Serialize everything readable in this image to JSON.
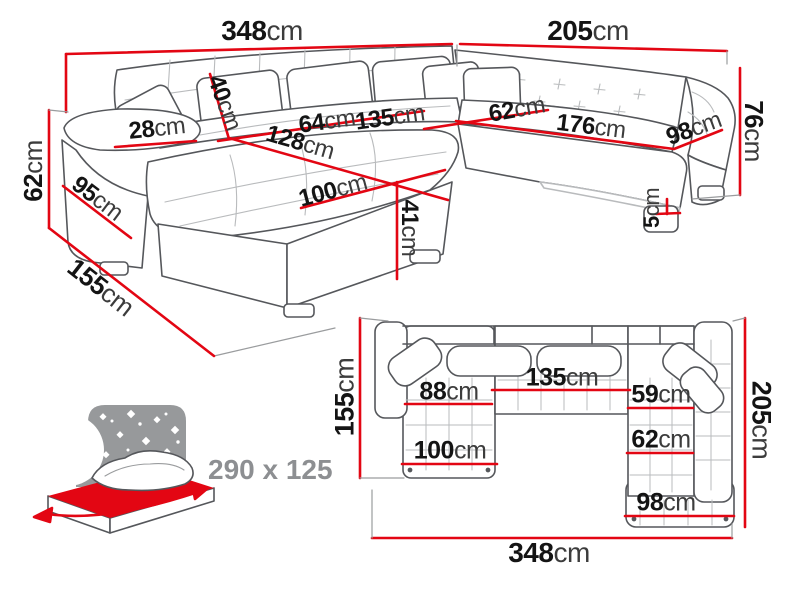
{
  "diagram_title": "corner-sofa-dimensions",
  "colors": {
    "dimension_red": "#e30613",
    "outline_gray": "#55575b",
    "quilt_gray": "#b9bbbd",
    "text_black": "#141414",
    "text_gray": "#8d8f92",
    "icon_gray": "#97999b",
    "mattress_red": "#e30613"
  },
  "perspective": {
    "dims": {
      "total_width": {
        "value": "348",
        "unit": "cm"
      },
      "right_width": {
        "value": "205",
        "unit": "cm"
      },
      "back_height": {
        "value": "76",
        "unit": "cm"
      },
      "arm_height": {
        "value": "62",
        "unit": "cm"
      },
      "cushion_height": {
        "value": "40",
        "unit": "cm"
      },
      "arm_top_width": {
        "value": "28",
        "unit": "cm"
      },
      "seat_left_width": {
        "value": "64",
        "unit": "cm"
      },
      "seat_mid_width": {
        "value": "135",
        "unit": "cm"
      },
      "chaise_length": {
        "value": "128",
        "unit": "cm"
      },
      "chaise_width": {
        "value": "100",
        "unit": "cm"
      },
      "seat_depth": {
        "value": "62",
        "unit": "cm"
      },
      "seat_right_width": {
        "value": "176",
        "unit": "cm"
      },
      "right_chaise_width": {
        "value": "98",
        "unit": "cm"
      },
      "seat_height": {
        "value": "41",
        "unit": "cm"
      },
      "leg_height": {
        "value": "5",
        "unit": "cm"
      },
      "arm_depth": {
        "value": "95",
        "unit": "cm"
      },
      "side_depth": {
        "value": "155",
        "unit": "cm"
      }
    }
  },
  "plan": {
    "dims": {
      "side_depth": {
        "value": "155",
        "unit": "cm"
      },
      "total_depth": {
        "value": "205",
        "unit": "cm"
      },
      "total_width": {
        "value": "348",
        "unit": "cm"
      },
      "left_seat_width": {
        "value": "88",
        "unit": "cm"
      },
      "mid_seat_width": {
        "value": "135",
        "unit": "cm"
      },
      "right_seat_width": {
        "value": "59",
        "unit": "cm"
      },
      "right_seat_depth": {
        "value": "62",
        "unit": "cm"
      },
      "left_chaise_width": {
        "value": "100",
        "unit": "cm"
      },
      "right_chaise_width": {
        "value": "98",
        "unit": "cm"
      }
    }
  },
  "sleep_function": {
    "dimensions": "290 x 125"
  }
}
